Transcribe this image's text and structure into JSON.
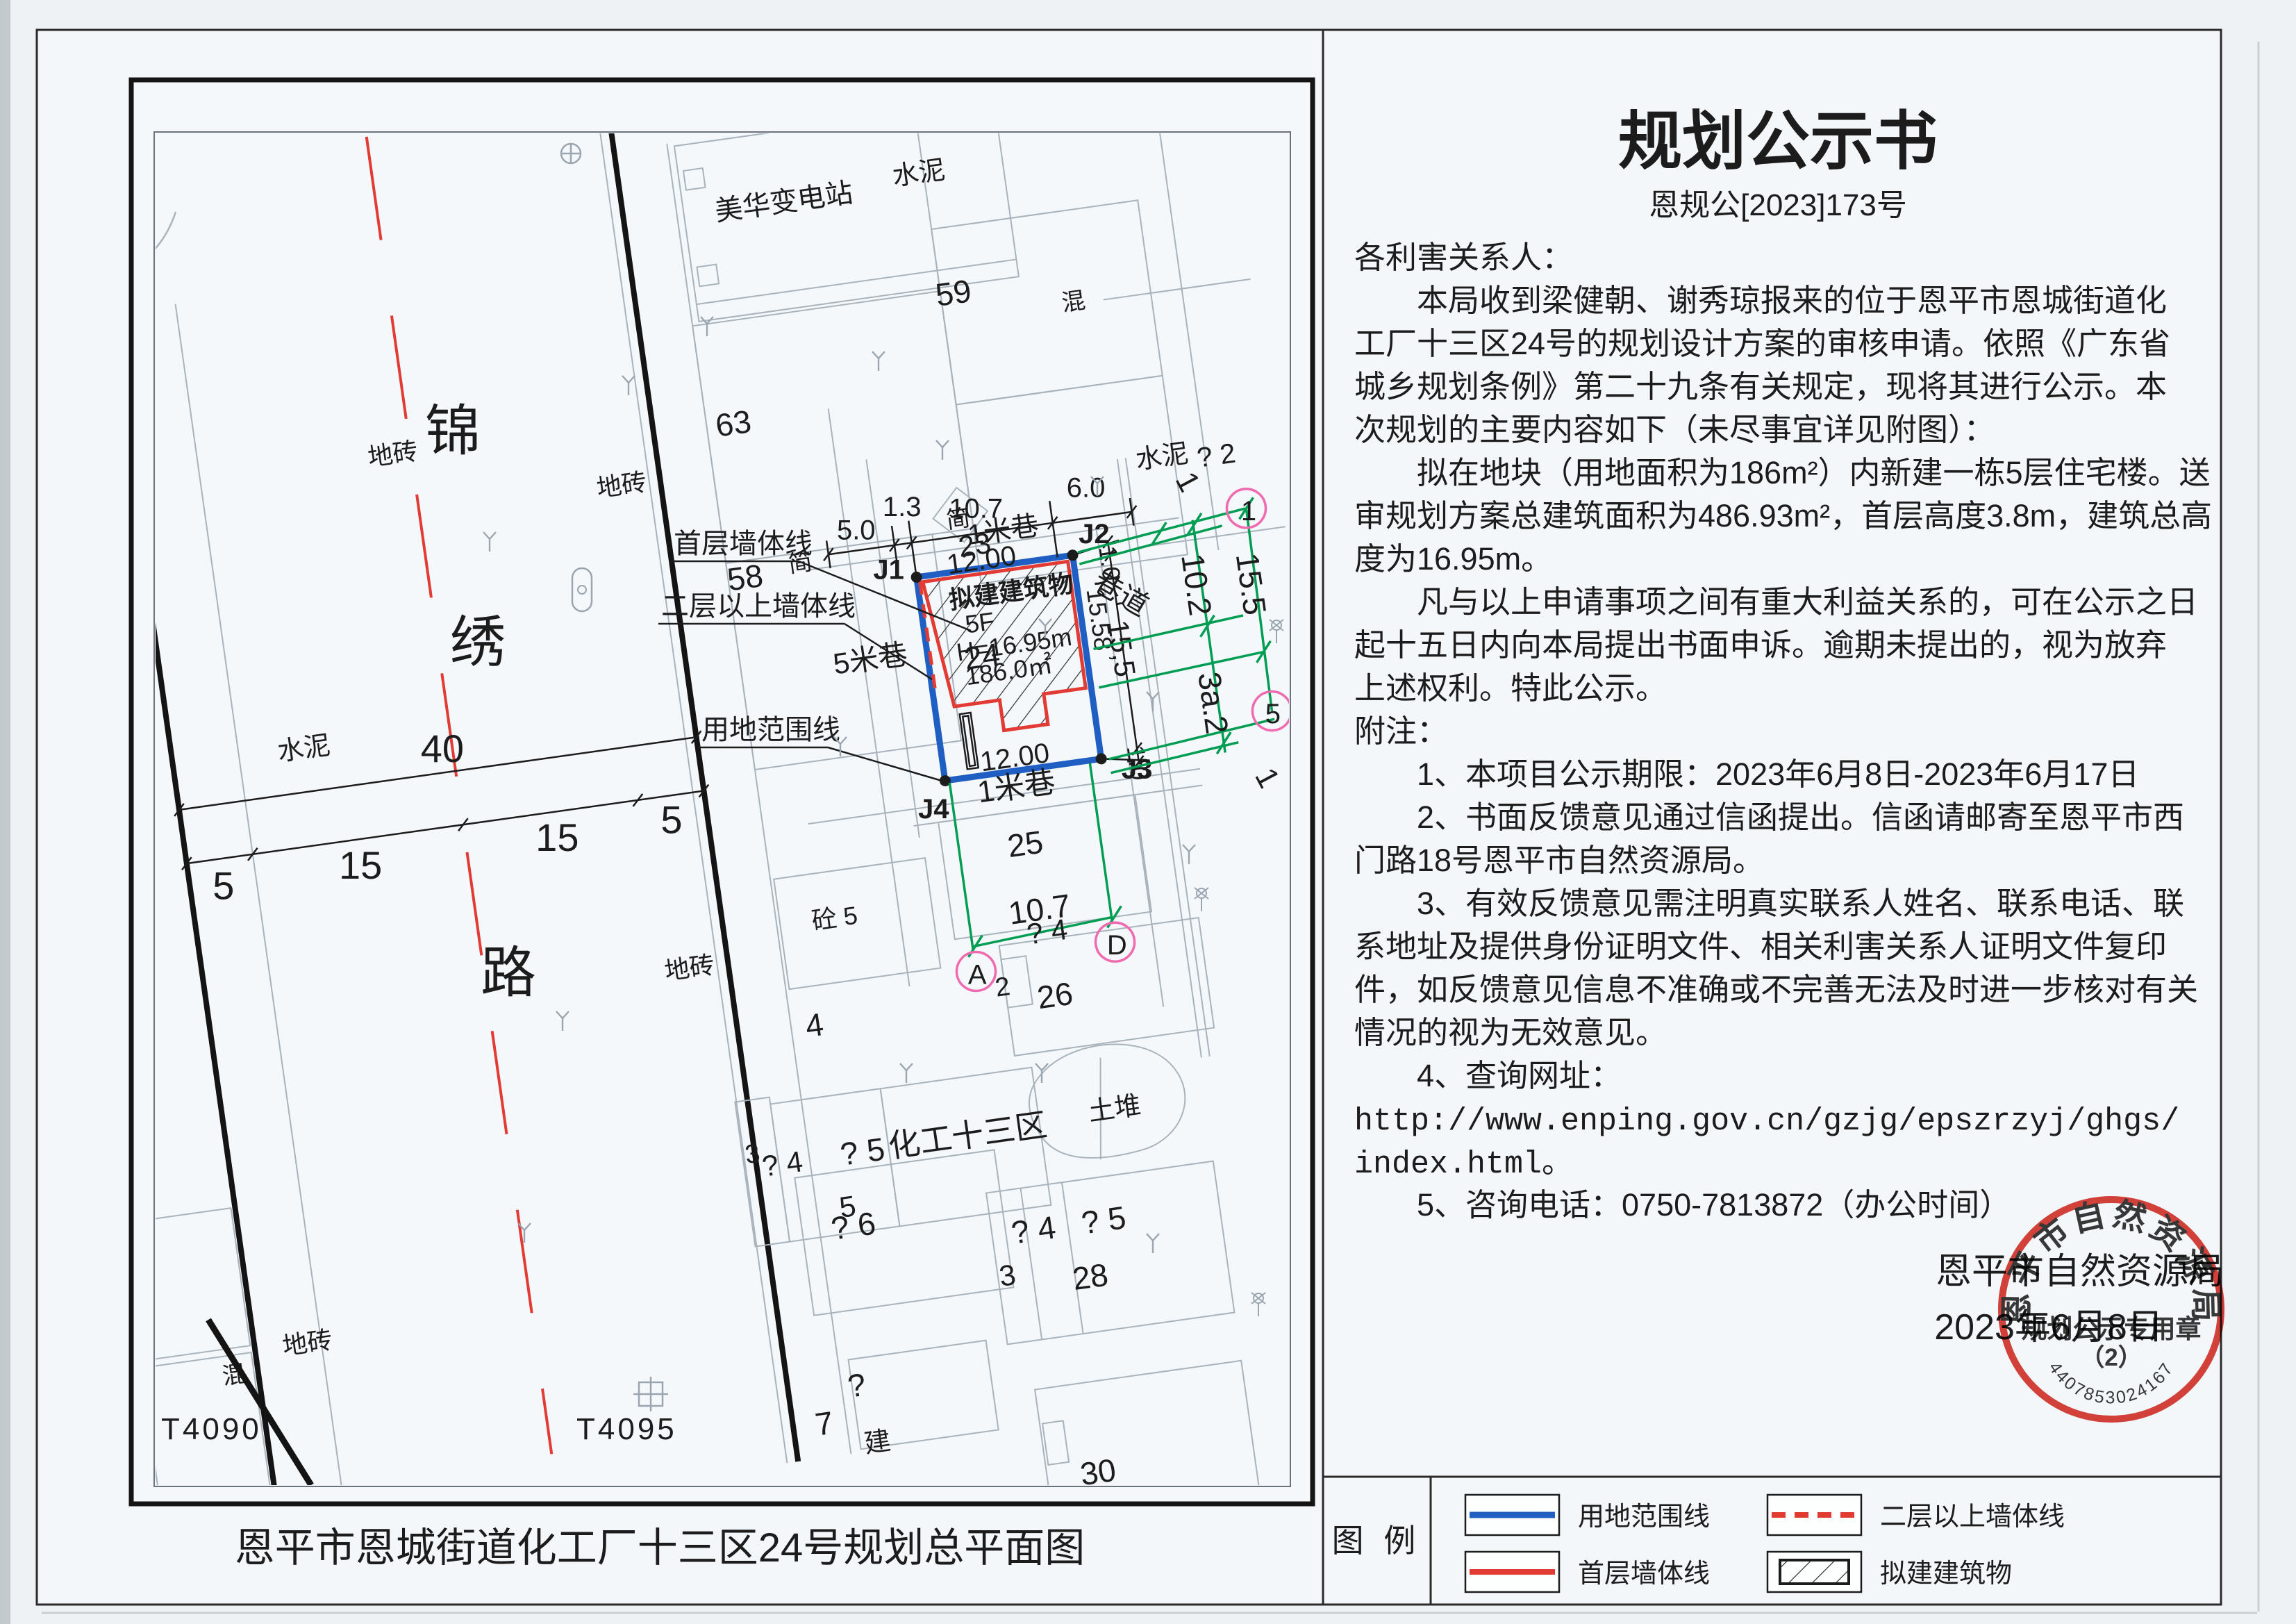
{
  "notice": {
    "title": "规划公示书",
    "doc_no": "恩规公[2023]173号",
    "lines": [
      "各利害关系人：",
      "　　本局收到梁健朝、谢秀琼报来的位于恩平市恩城街道化",
      "工厂十三区24号的规划设计方案的审核申请。依照《广东省",
      "城乡规划条例》第二十九条有关规定，现将其进行公示。本",
      "次规划的主要内容如下（未尽事宜详见附图）：",
      "　　拟在地块（用地面积为186m²）内新建一栋5层住宅楼。送",
      "审规划方案总建筑面积为486.93m²，首层高度3.8m，建筑总高",
      "度为16.95m。",
      "　　凡与以上申请事项之间有重大利益关系的，可在公示之日",
      "起十五日内向本局提出书面申诉。逾期未提出的，视为放弃",
      "上述权利。特此公示。",
      "附注：",
      "　　1、本项目公示期限：2023年6月8日-2023年6月17日",
      "　　2、书面反馈意见通过信函提出。信函请邮寄至恩平市西",
      "门路18号恩平市自然资源局。",
      "　　3、有效反馈意见需注明真实联系人姓名、联系电话、联",
      "系地址及提供身份证明文件、相关利害关系人证明文件复印",
      "件，如反馈意见信息不准确或不完善无法及时进一步核对有关",
      "情况的视为无效意见。",
      "　　4、查询网址：",
      "http://www.enping.gov.cn/gzjg/epszrzyj/ghgs/",
      "index.html。",
      "　　5、咨询电话：0750-7813872（办公时间）"
    ],
    "sign_org": "恩平市自然资源局",
    "sign_date": "2023年6月8日",
    "seal": {
      "arc": "恩平市自然资源局",
      "line1": "规划公示专用章",
      "line2": "（2）",
      "serial": "4407853024167"
    }
  },
  "map": {
    "title": "恩平市恩城街道化工厂十三区24号规划总平面图",
    "labels": {
      "road_name_1": "锦",
      "road_name_2": "绣",
      "road_name_3": "路",
      "road_dim_total": "40",
      "road_dim_w1": "5",
      "road_dim_w2": "15",
      "road_dim_w3": "15",
      "road_dim_w4": "5",
      "dim_top_1": "5.0",
      "dim_top_2": "1.3",
      "dim_top_3": "10.7",
      "dim_top_4": "6.0",
      "dim_right_off1": "1.0",
      "dim_right_len": "15,5",
      "dim_right_off2": "1.0",
      "green_1a": "1",
      "green_10_2": "10.2",
      "green_15_5": "15.5",
      "green_3a2": "3a.2",
      "green_1b": "1",
      "green_10_7": "10.7",
      "pt_1": "1",
      "pt_5": "5",
      "pt_a": "A",
      "pt_d": "D",
      "j1": "J1",
      "j2": "J2",
      "j3": "J3",
      "j4": "J4",
      "bldg_line1": "拟建建筑物",
      "bldg_line2": "5F",
      "bldg_line3": "H=16.95m",
      "bldg_line4": "186.0㎡",
      "bldg_dim_top": "12.00",
      "bldg_dim_bottom": "12.00",
      "bldg_dim_right": "15.58",
      "parcel_24": "24",
      "callout_wall1": "首层墙体线",
      "callout_wall2": "二层以上墙体线",
      "callout_boundary": "用地范围线",
      "lane_1m_a": "1米巷",
      "lane_1m_b": "1米巷",
      "lane_5m": "5米巷",
      "lane_alley": "巷道",
      "substation": "美华变电站",
      "shuini_a": "水泥",
      "shuini_b": "水泥",
      "shuini_c": "水泥",
      "dizhuan_a": "地砖",
      "dizhuan_b": "地砖",
      "dizhuan_c": "地砖",
      "dizhuan_d": "地砖",
      "hun_a": "混",
      "hun_b": "混",
      "jian_a": "简",
      "jian_b": "简",
      "n59": "59",
      "n63": "63",
      "n58": "58",
      "n23": "23",
      "n25": "25",
      "n26": "26",
      "n28": "28",
      "n30": "30",
      "n2": "2",
      "n4": "4",
      "n5": "5",
      "n7": "7",
      "n3a": "3",
      "n3b": "3",
      "q2": "? 2",
      "q4a": "? 4",
      "q4b": "? 4",
      "q4c": "? 4",
      "q5a": "? 5",
      "q5b": "? 5",
      "q6": "? 6",
      "qm": "?",
      "tong5": "砼 5",
      "tudui": "土堆",
      "huagong_area": "化工十三区",
      "jian_build": "建",
      "t4090": "T4090",
      "t4095": "T4095"
    }
  },
  "legend": {
    "title": "图 例",
    "items": [
      {
        "swatch": "blue-solid-line",
        "label": "用地范围线"
      },
      {
        "swatch": "red-dashed-line",
        "label": "二层以上墙体线"
      },
      {
        "swatch": "red-solid-line",
        "label": "首层墙体线"
      },
      {
        "swatch": "hatched-box",
        "label": "拟建建筑物"
      }
    ]
  },
  "colors": {
    "boundary_blue": "#1f5fc4",
    "wall_red": "#e23b34",
    "survey_green": "#019d52",
    "station_pink": "#f06ab0",
    "seal_red": "#d7281e"
  }
}
